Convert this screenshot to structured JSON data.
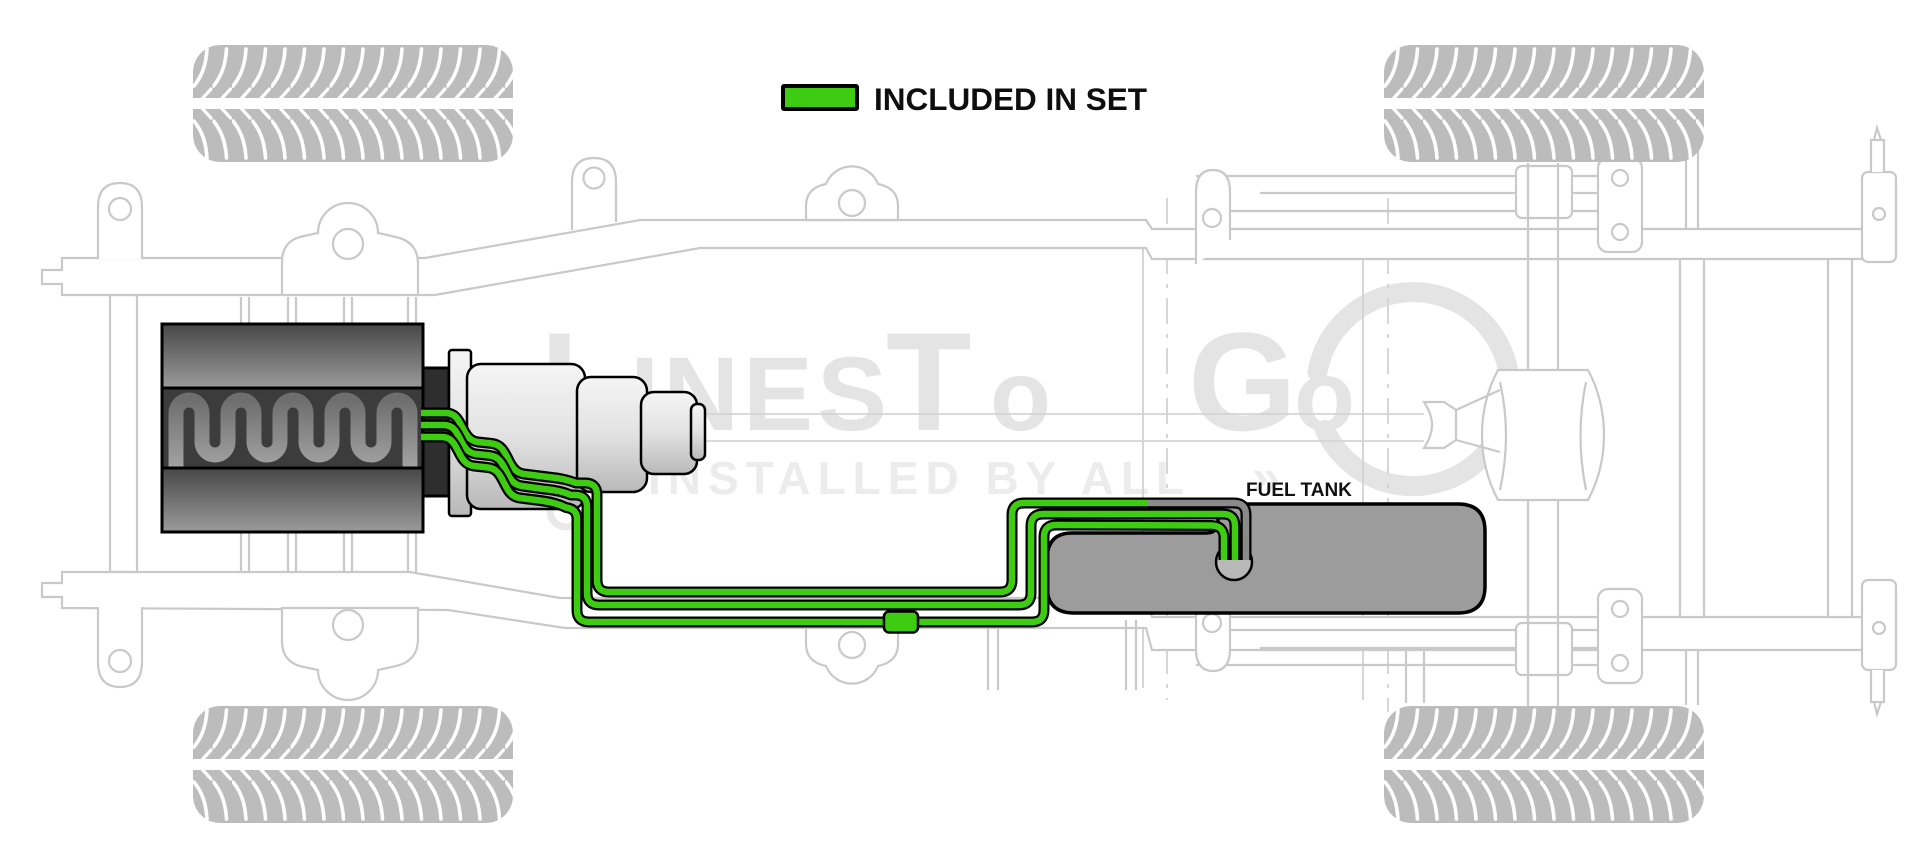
{
  "legend": {
    "label": "INCLUDED IN SET",
    "swatch_color": "#3ECC12"
  },
  "labels": {
    "fuel_tank": "FUEL TANK"
  },
  "watermark": {
    "brand_segments": [
      "L",
      "INES",
      "T",
      "o",
      "G",
      "o"
    ],
    "tagline": "INSTALLED BY ALL",
    "arrow": "»"
  },
  "colors": {
    "included_green": "#3ECC12",
    "excluded_gray": "#8a8a8a",
    "line_outline": "#000000",
    "tank_gray": "#9c9c9c",
    "sender_gray": "#b9b9b9",
    "chassis_gray": "#c9c9c9",
    "tire_gray": "#bcbcbc",
    "watermark_gray": "#e4e4e4"
  }
}
